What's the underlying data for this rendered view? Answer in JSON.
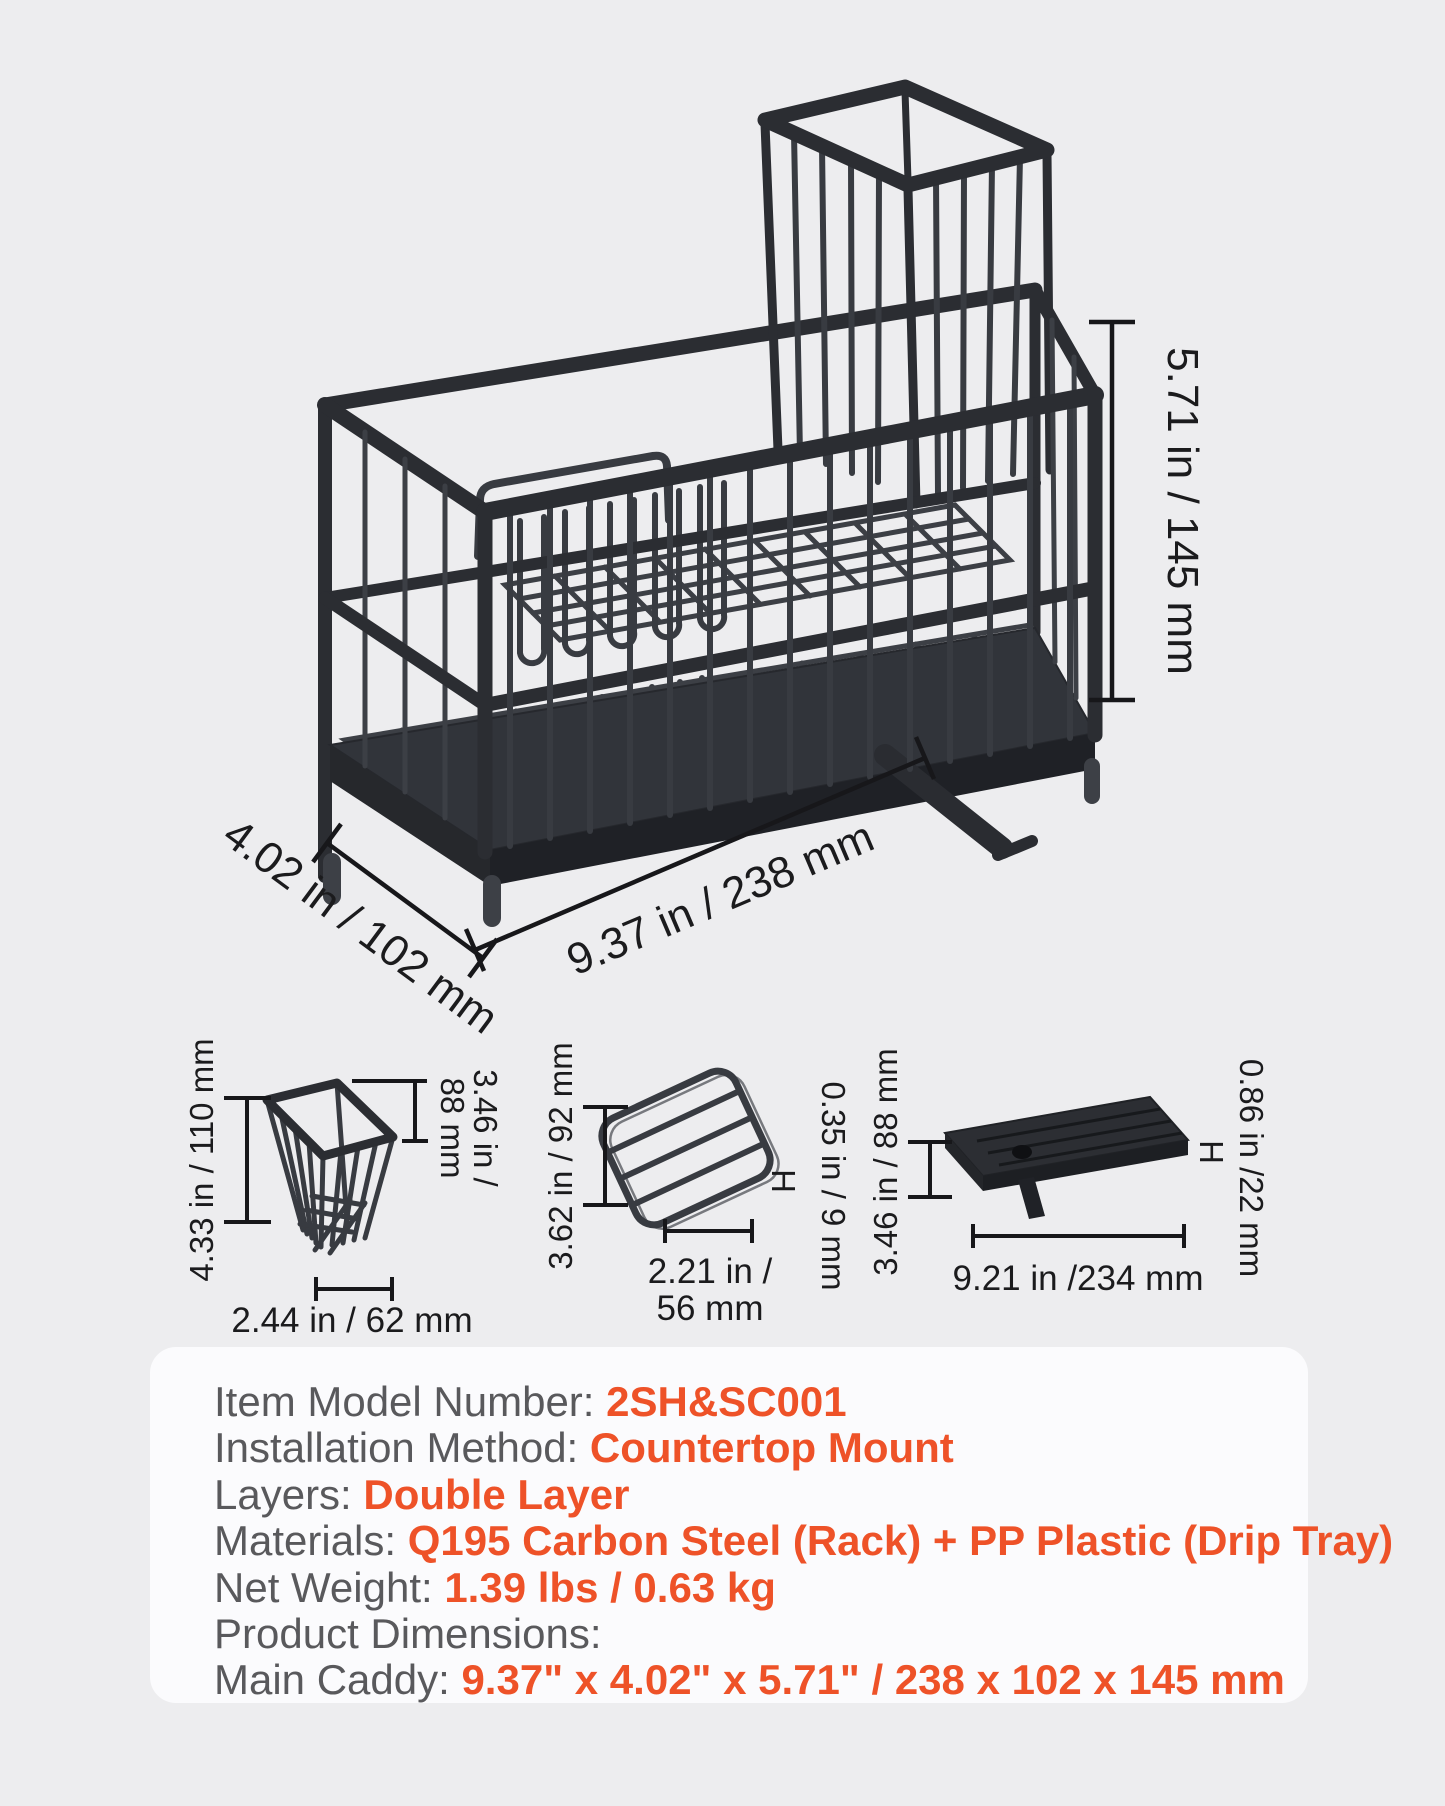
{
  "figure": {
    "type": "product-dimension-diagram",
    "main_caddy": {
      "height_label": "5.71 in / 145 mm",
      "depth_label": "4.02 in / 102 mm",
      "width_label": "9.37 in / 238 mm"
    },
    "utensil_basket": {
      "height_label": "4.33 in / 110 mm",
      "inner_height_line1": "3.46 in /",
      "inner_height_line2": "88 mm",
      "width_label": "2.44 in / 62 mm"
    },
    "small_rack": {
      "length_label": "3.62 in / 92 mm",
      "thickness_label": "0.35 in / 9 mm",
      "thickness_marker": "H",
      "width_line1": "2.21 in /",
      "width_line2": "56 mm"
    },
    "drip_tray": {
      "depth_label": "3.46 in / 88 mm",
      "height_label": "0.86 in /22 mm",
      "height_marker": "H",
      "length_label": "9.21 in /234 mm"
    }
  },
  "specs": {
    "rows": [
      {
        "label": "Item Model Number: ",
        "value": "2SH&SC001"
      },
      {
        "label": "Installation Method: ",
        "value": "Countertop Mount"
      },
      {
        "label": "Layers: ",
        "value": "Double Layer"
      },
      {
        "label": "Materials: ",
        "value": "Q195 Carbon Steel (Rack) + PP Plastic (Drip Tray)"
      },
      {
        "label": "Net Weight: ",
        "value": "1.39 lbs / 0.63 kg"
      },
      {
        "label": "Product Dimensions:",
        "value": ""
      },
      {
        "label": "Main Caddy: ",
        "value": "9.37\" x 4.02\" x 5.71\" / 238 x 102 x 145 mm"
      }
    ]
  },
  "colors": {
    "page_background": "#EDEDEF",
    "panel_background": "#FBFBFD",
    "spec_label_gray": "#59595C",
    "accent_orange": "#EE5228",
    "dimension_line": "#17171A",
    "product_dark": "#2B2D32"
  }
}
